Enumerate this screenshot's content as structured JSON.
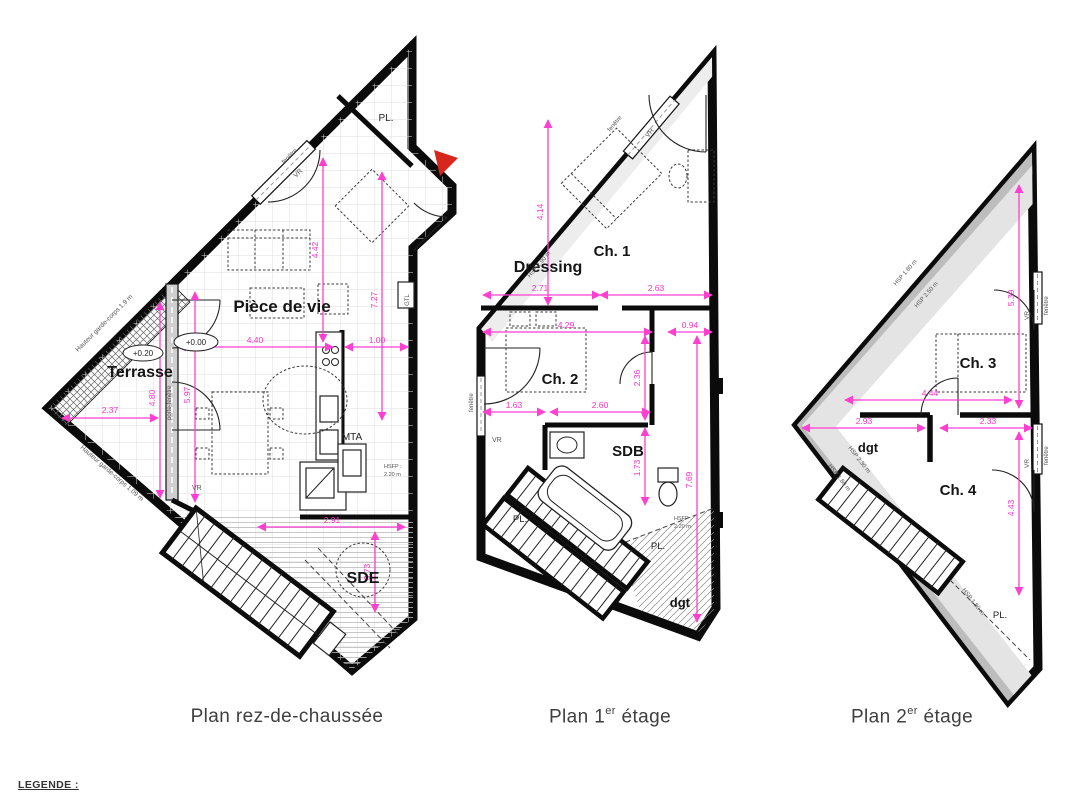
{
  "colors": {
    "dimension_pink": "#ff3fd0",
    "wall_black": "#0b0b0b",
    "slope_gray_dark": "#bdbdbd",
    "slope_gray_light": "#e4e4e4",
    "entrance_red": "#d7271d"
  },
  "legend_label": "LEGENDE :",
  "captions": {
    "rdc": "Plan rez-de-chaussée",
    "first_pre": "Plan 1",
    "first_sup": "er",
    "first_post": " étage",
    "second_pre": "Plan 2",
    "second_sup": "er",
    "second_post": " étage"
  },
  "rdc": {
    "rooms": {
      "living": "Pièce de vie",
      "terrace": "Terrasse",
      "shower_room": "SDE",
      "closet": "PL.",
      "mta": "MTA",
      "gtl": "GTL"
    },
    "levels": {
      "floor": "+0.00",
      "terrace": "+0.20"
    },
    "dims": {
      "living_w": "4.40",
      "kitchen_w": "1.00",
      "living_h": "4.42",
      "right_h": "7.27",
      "hall_h": "5.97",
      "terrace_h": "4.80",
      "terrace_w": "2.37",
      "sde_w": "2.91",
      "sde_h": "3.73"
    },
    "notes": {
      "vr_top": "VR",
      "vr_terrace": "VR",
      "window": "fenêtre",
      "door_window": "porte-fenêtre",
      "guard_top": "Hauteur garde-corps 1.9 m",
      "guard_bottom": "Hauteur garde-corps 1.09 m",
      "hsfp_1": "HSFP :",
      "hsfp_2": "2.20 m"
    }
  },
  "first": {
    "rooms": {
      "ch1": "Ch. 1",
      "ch2": "Ch. 2",
      "dressing": "Dressing",
      "sdb": "SDB",
      "pl_left": "PL.",
      "pl_right": "PL.",
      "dgt": "dgt"
    },
    "dims": {
      "ch1_h": "4.14",
      "dressing_w": "2.71",
      "ch1_w": "2.63",
      "ch2_w": "4.29",
      "niche_w": "0.94",
      "ch2_h": "2.36",
      "sdb_left": "1.63",
      "sdb_w": "2.60",
      "sdb_h": "1.73",
      "right_h": "7.69"
    },
    "notes": {
      "vr_top": "VR",
      "vr_left": "VR",
      "window_top": "fenêtre",
      "window_left": "fenêtre",
      "hsp": "HSP 2.90 m",
      "hsfp_1": "HSFP :",
      "hsfp_2": "2.20 m"
    }
  },
  "second": {
    "rooms": {
      "ch3": "Ch. 3",
      "ch4": "Ch. 4",
      "dgt": "dgt",
      "pl": "PL."
    },
    "dims": {
      "ch3_h": "5.39",
      "ch3_w": "4.44",
      "dgt_w": "2.93",
      "ch4_w": "2.33",
      "ch4_h": "4.43"
    },
    "notes": {
      "vr_1": "VR",
      "vr_2": "VR",
      "window_1": "fenêtre",
      "window_2": "fenêtre",
      "hsp_hyp_outer": "HSP 1.80 m",
      "hsp_hyp_inner": "HSP 2.50 m",
      "hsp_bottom_inner": "HSP 2.30 m",
      "hsp_bottom_outer": "HSP 1.80 m",
      "hsp_pl": "HSP 1.80 m"
    }
  }
}
